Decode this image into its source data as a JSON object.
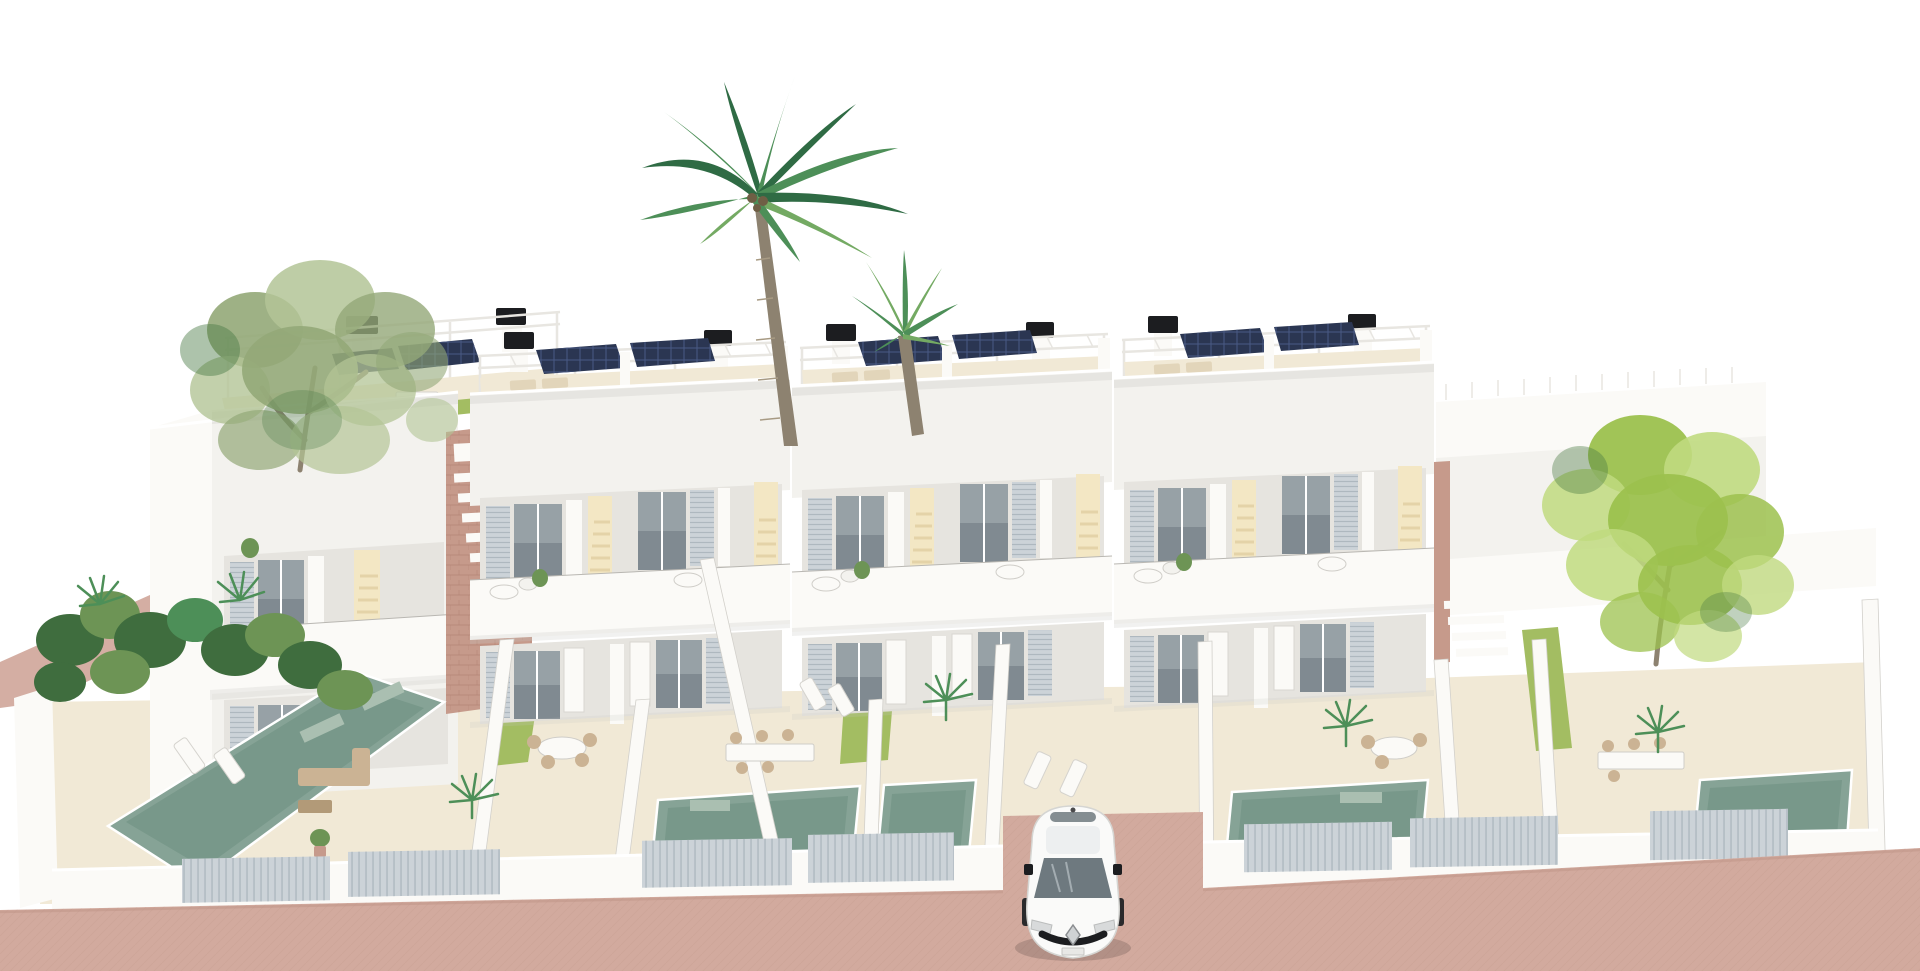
{
  "page": {
    "title": "New-build villas — 3D architectural rendering",
    "kind": "3d-architectural-render",
    "canvas": "1920x971"
  },
  "scene": {
    "description": "Aerial front view 3D rendering of a row of four modern two-storey white villas. Each villa has a rooftop terrace with white pergola frame, dark solar panels, black chimney caps and artificial grass, a first-floor balcony with a small round table, and a ground-floor terrace and garden with a plunge pool. White privacy walls and a white street wall with grey slatted gates enclose the plots. A tall coconut palm and a second palm rise between the villas, a loose eucalyptus tree stands at the left roof and a bright green leafy tree at the right end. A white hatchback car with a diamond badge is parked on the terracotta-pink paved street at the central driveway.",
    "sky": "white",
    "style": "photoreal render, bright daylight"
  },
  "inventory": {
    "villas": 4,
    "visible_pools": 5,
    "solar_panel_arrays": 7,
    "chimney_caps": 9,
    "palm_trees": 2,
    "leafy_trees": 2,
    "gates": 7,
    "cars": 1
  },
  "car": {
    "body": "hatchback, top-front view",
    "color_name": "white",
    "badge": "diamond emblem",
    "details": [
      "dark windshield",
      "black grille band",
      "side mirrors",
      "roof antenna"
    ]
  },
  "colors": {
    "sky": "#ffffff",
    "wall": "#f3f2ee",
    "wall-bright": "#fbfaf7",
    "wall-shade": "#e6e4df",
    "wall-dark": "#c9c7c2",
    "edge": "#b9b7b2",
    "pergola": "#e8e6e1",
    "floor": "#f1e9d6",
    "floor-shade": "#e2d5ba",
    "grass": "#a3bd62",
    "grass-dark": "#7fa04a",
    "hedge": "#6d9455",
    "garden-dark": "#3f6d3e",
    "pool": "#86a396",
    "pool-dark": "#698d7e",
    "pool-light": "#aabfb1",
    "glass": "#97a1a6",
    "glass-dark": "#6e797f",
    "shutter": "#ccd3d8",
    "shutter-line": "#aeb8bf",
    "warm-glow": "#f3e7c4",
    "step-warm": "#e4d3a8",
    "brick": "#c69a8b",
    "brick-dark": "#b28374",
    "pavement": "#d2aa9e",
    "pavement-dark": "#c2988b",
    "panel": "#2b3652",
    "panel-line": "#4a5a85",
    "black": "#1c1d20",
    "trunk": "#8d8270",
    "wood": "#cbb394",
    "wood-dark": "#b29a78",
    "palm1": "#2f6b44",
    "palm2": "#4d8f58",
    "palm3": "#74aa63",
    "tree-left1": "#93a878",
    "tree-left2": "#b3c496",
    "tree-right1": "#9cc14e",
    "tree-right2": "#c0da7f",
    "tree-dark": "#4a7a44"
  }
}
